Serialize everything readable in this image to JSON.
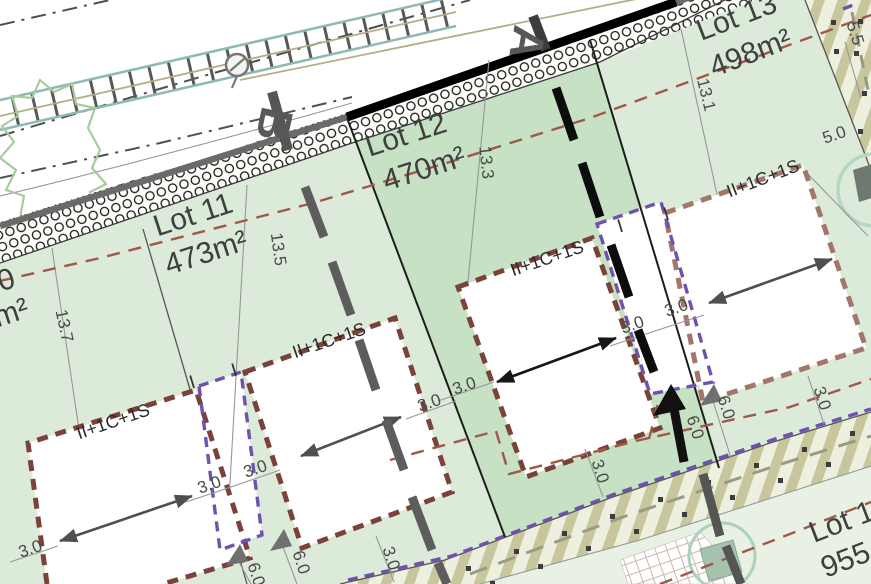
{
  "plan": {
    "sections": {
      "a": "A",
      "b": "B"
    },
    "lots": {
      "lot10": {
        "name_fragment": "0",
        "area_fragment": "m²"
      },
      "lot11": {
        "name": "Lot 11",
        "area": "473m²"
      },
      "lot12": {
        "name": "Lot 12",
        "area": "470m²"
      },
      "lot13": {
        "name": "Lot 13",
        "area": "498m²"
      },
      "lot_south": {
        "name_fragment": "Lot 1",
        "area_fragment": "955"
      }
    },
    "building_code": "II+1C+1S",
    "annex_code": "I",
    "dims": {
      "d13_7": "13.7",
      "d13_5": "13.5",
      "d13_3": "13.3",
      "d13_1": "13.1",
      "d5_5": "5.5",
      "d5_0": "5.0",
      "d3_0": "3.0",
      "d6_0": "6.0"
    },
    "colors": {
      "lot_fill": "#dcead9",
      "lot12_fill": "#c6e1c4",
      "lot_south_fill": "#e9f1e4",
      "road_hatch_ink": "#161616",
      "setback_dash": "#a05848",
      "building_dash": "#7a4238",
      "building_dash_light": "#a3766b",
      "annex_dash": "#7052ae",
      "stripe": "#c8c69c",
      "section_a": "#0c0c0c",
      "section_b": "#5d5d5d",
      "teal_line": "#8fb9b4",
      "tree_outline": "#a6cc9e"
    }
  }
}
